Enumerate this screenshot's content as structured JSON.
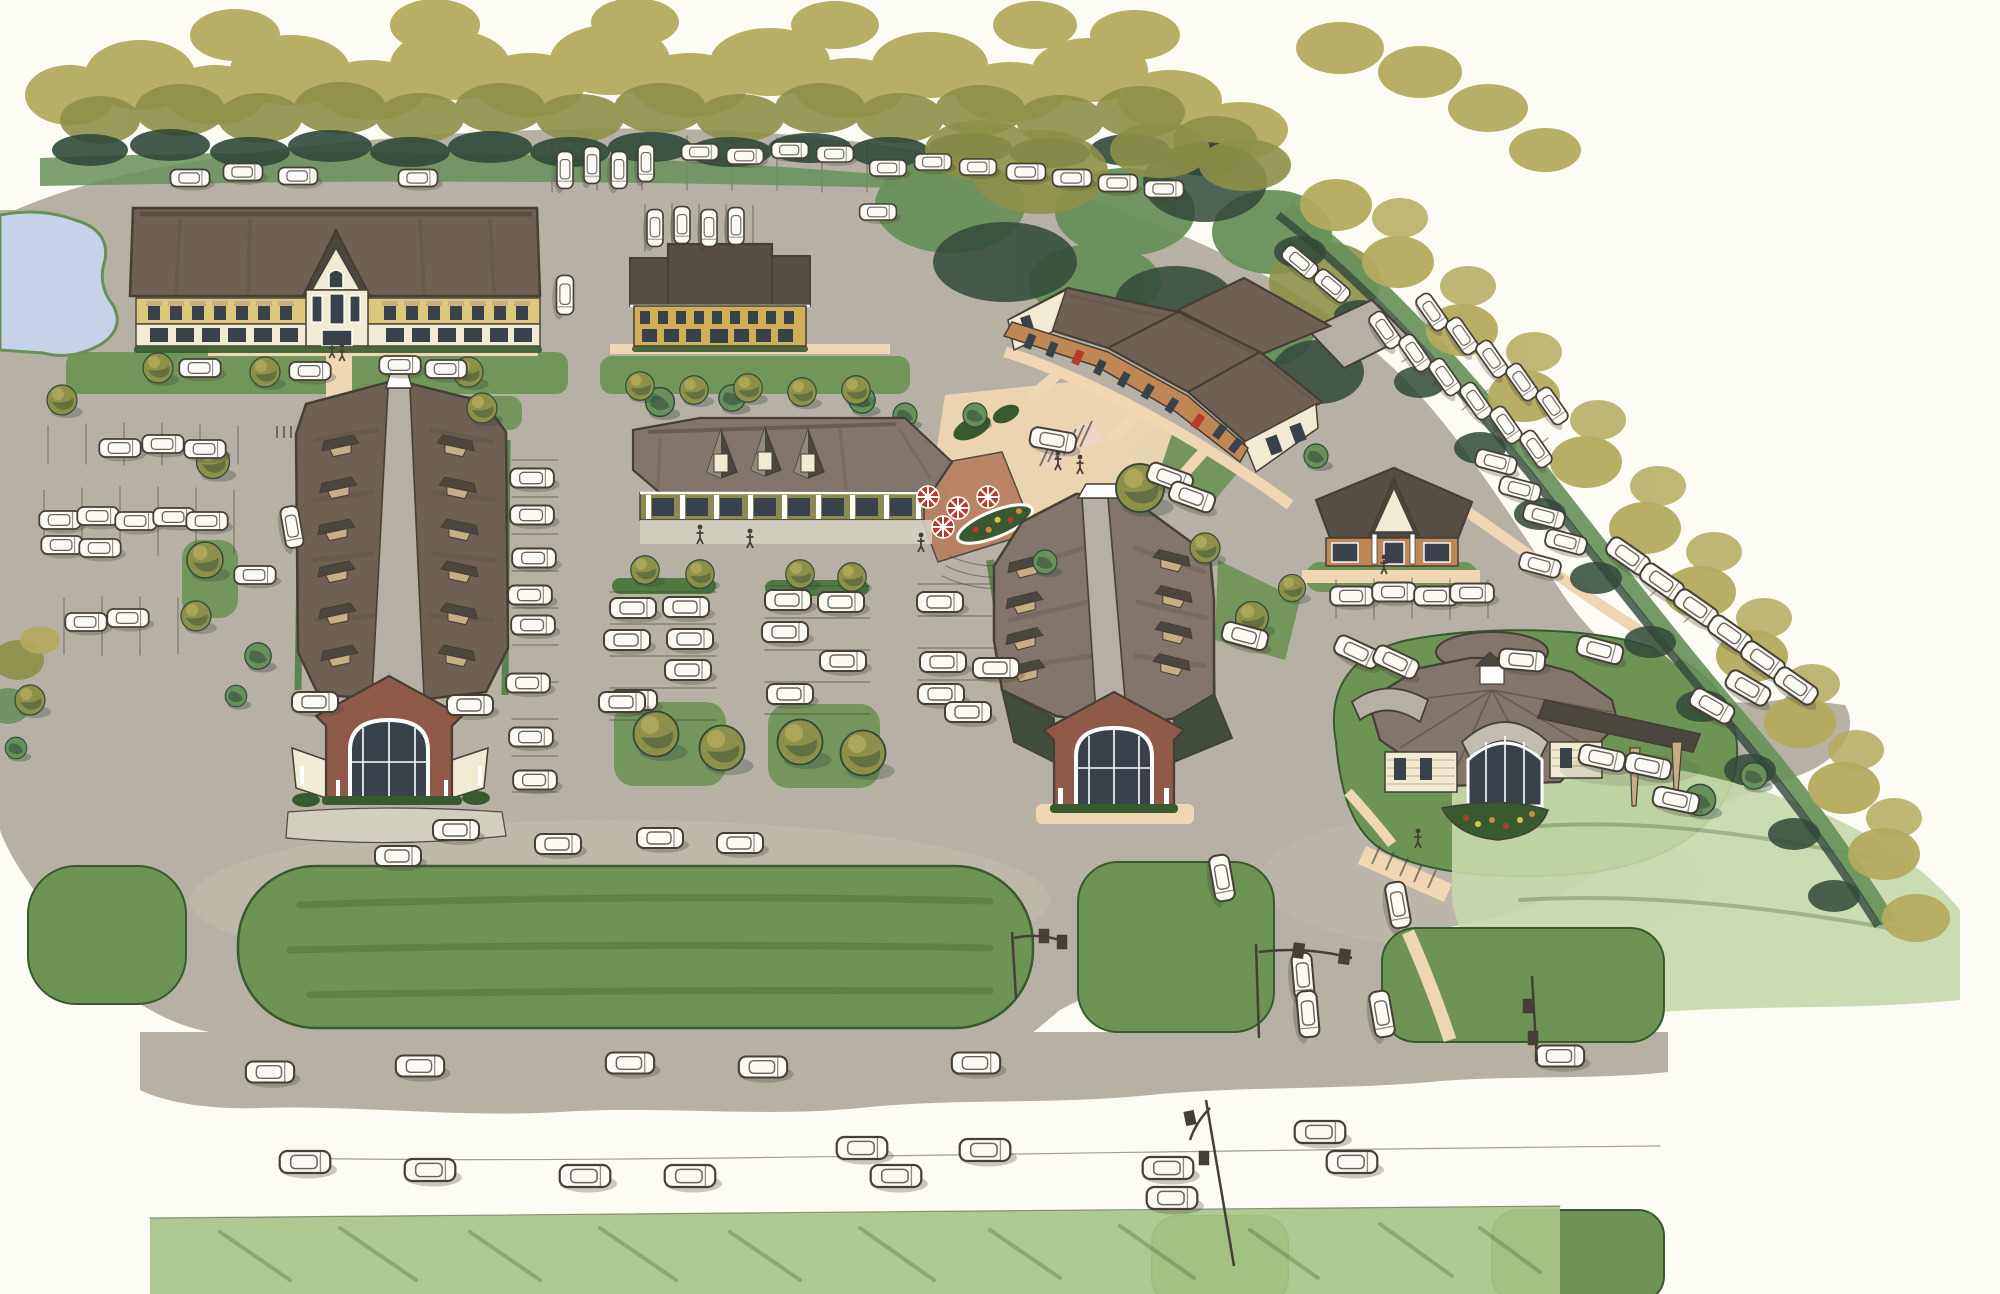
{
  "scene": {
    "title": "Aerial marker-and-watercolor architectural rendering of a suburban retail village",
    "description": "Hand-drawn bird's-eye site rendering: eight pitched-roof commercial buildings around parking lots filled with white sketched cars, perimeter tree masses in olive and dark green marker, a small pond at the west edge, a central cafe plaza with red umbrellas, lawns and a landscaped median along the boulevard at the bottom with traffic signal poles. No text appears in the image.",
    "medium": "marker / watercolor sketch on white paper",
    "view": "aerial perspective"
  },
  "palette": {
    "paper": "#fcfbf4",
    "pav": "#b6b1a4",
    "pavLight": "#cac5b8",
    "conc": "#d6d2c4",
    "peach": "#eed7b2",
    "pink": "#ecd6c3",
    "brickPav": "#b67c5e",
    "lawn": "#6d9454",
    "lawnDark": "#4f7a41",
    "lawnDeep": "#39592f",
    "pencil": "#a9c489",
    "pencil2": "#c6d8ab",
    "khaki": "#b4ab5e",
    "olive": "#8d9048",
    "green": "#68915a",
    "teal": "#31493a",
    "roofDark": "#574f44",
    "roofBrown": "#6e6053",
    "roofMauve": "#82756b",
    "roofLight": "#b6afa5",
    "roofSlate": "#4b463e",
    "roofTeal": "#404c3c",
    "wallYellow": "#ddc77c",
    "wallMustard": "#d0b057",
    "cream": "#f1ebd3",
    "wallOlive": "#8b8951",
    "wallTan": "#c08756",
    "brick": "#8f5a47",
    "win": "#39424a",
    "white": "#ffffff",
    "car": "#fbfaf5",
    "ink": "#453f35",
    "water": "#c7d1e8",
    "wood": "#c8ae85",
    "red": "#b93a2c",
    "orange": "#d28a3c",
    "yellowFl": "#d8c44d",
    "silver": "#c2bcb2"
  },
  "site": {
    "buildings": [
      {
        "id": "office-northwest",
        "form": "long two-story office, hipped brown roof, central gabled entry tower",
        "walls": "yellow upper band over cream storefronts"
      },
      {
        "id": "office-north-center",
        "form": "small two-story office with three dark roof sections",
        "walls": "mustard yellow"
      },
      {
        "id": "retail-strip-northeast",
        "form": "angled retail strip with linked taupe gable roofs and cream end pediments",
        "walls": "tan storefronts with red doors"
      },
      {
        "id": "pavilion-center-east",
        "form": "small hip-roof pavilion with white portico",
        "walls": "orange-tan"
      },
      {
        "id": "retail-long-west",
        "form": "long retail hall, clerestory ridge skylight, shed dormers, brick entry gable with arched window"
      },
      {
        "id": "retail-center",
        "form": "one-story retail with three pointed dormers and cafe patio with umbrellas",
        "walls": "olive green"
      },
      {
        "id": "retail-long-center-east",
        "form": "long retail hall, clerestory ridge, shed dormers, brick entry gable with arched window"
      },
      {
        "id": "restaurant-east",
        "form": "radial hip-roof pavilion, arched entry canopy, drive-through canopy on tapered wood posts, flower bed at entry"
      }
    ],
    "landscape": {
      "perimeter_trees": "dense olive, khaki and dark green marker tree band along north edge and diagonal southeast hedge row",
      "pond": "small blue pond at west edge",
      "lawns": "rounded boulevard median, corner lawn panels at the signalized entrance, colored-pencil lawn bands along bottom and east",
      "street_trees_approx": 35
    },
    "circulation": {
      "parking_cars_approx": 115,
      "roads": "internal drives, angled parking courts, boulevard with two lanes at bottom",
      "traffic_signals": 4,
      "crosswalks": 3,
      "people_approx": 9
    }
  }
}
